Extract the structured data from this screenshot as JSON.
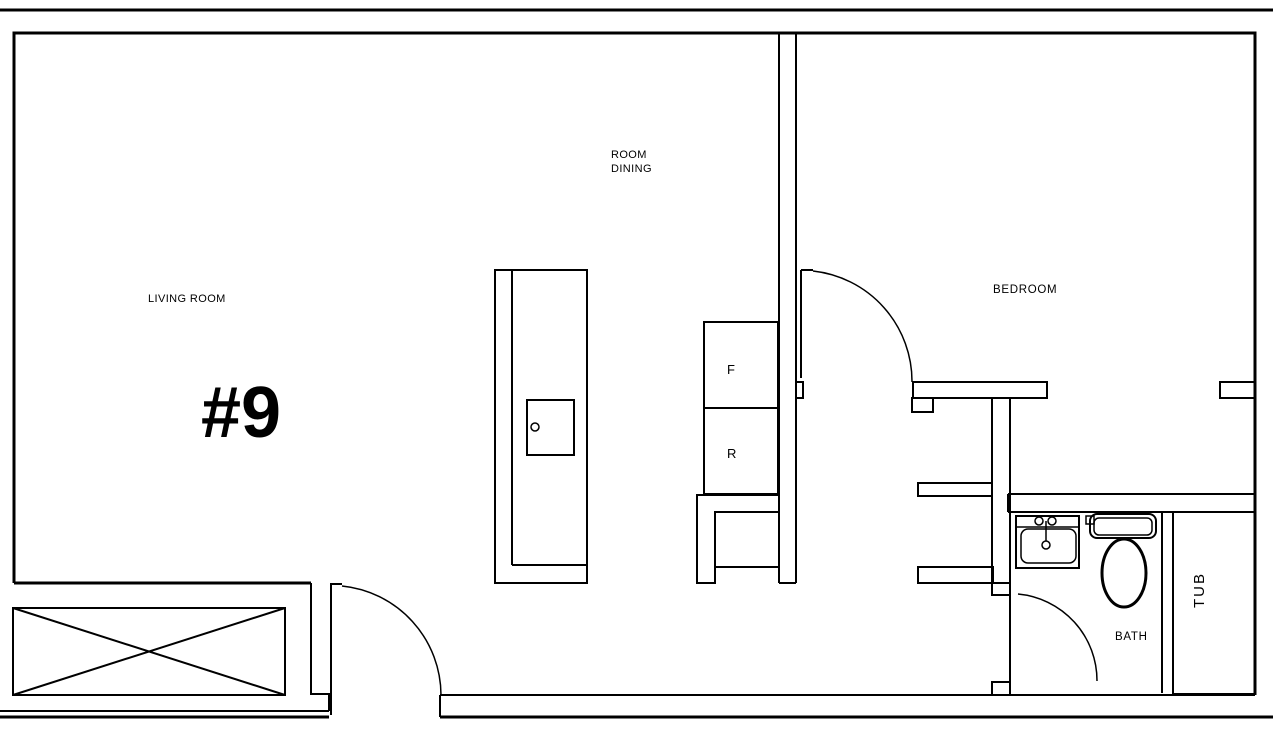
{
  "title": "Apartment unit floor plan",
  "colors": {
    "line": "#000000",
    "background": "#ffffff"
  },
  "labels": {
    "unit_number": "#9",
    "living_room": "LIVING ROOM",
    "dining_line1": "ROOM",
    "dining_line2": "DINING",
    "bedroom": "BEDROOM",
    "bath": "BATH",
    "tub": "TUB",
    "refrigerator": "F",
    "range": "R"
  }
}
